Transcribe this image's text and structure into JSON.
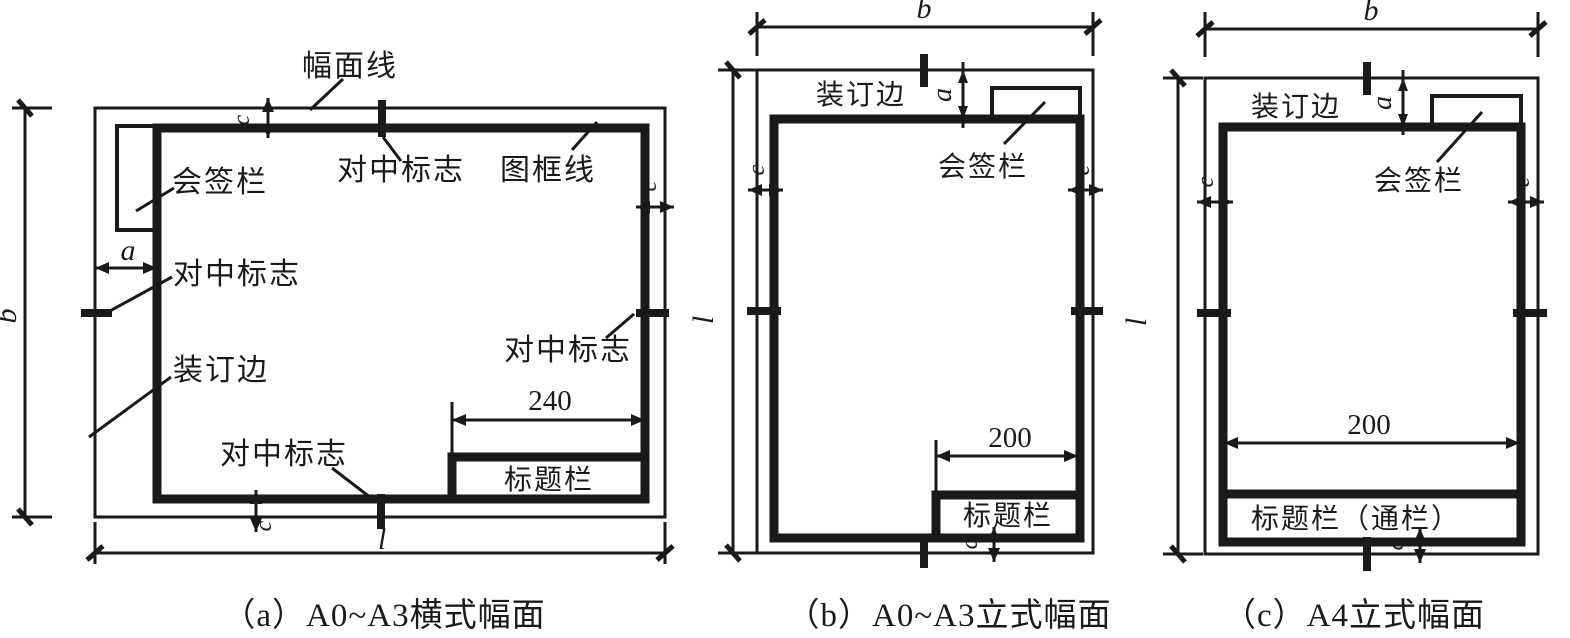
{
  "colors": {
    "ink": "#1a1a1a",
    "background": "#ffffff"
  },
  "diagram_a": {
    "caption": "（a）A0~A3横式幅面",
    "labels": {
      "sheet_line": "幅面线",
      "frame_line": "图框线",
      "centering_mark": "对中标志",
      "signature_bar": "会签栏",
      "binding_edge": "装订边",
      "title_block": "标题栏"
    },
    "dims": {
      "height": "b",
      "length": "l",
      "binding": "a",
      "margin": "c",
      "title_width": "240"
    }
  },
  "diagram_b": {
    "caption": "（b）A0~A3立式幅面",
    "labels": {
      "binding_edge": "装订边",
      "signature_bar": "会签栏",
      "title_block": "标题栏"
    },
    "dims": {
      "width": "b",
      "height": "l",
      "binding": "a",
      "margin": "c",
      "title_width": "200"
    }
  },
  "diagram_c": {
    "caption": "（c）A4立式幅面",
    "labels": {
      "binding_edge": "装订边",
      "signature_bar": "会签栏",
      "title_block": "标题栏（通栏）"
    },
    "dims": {
      "width": "b",
      "height": "l",
      "binding": "a",
      "margin": "c",
      "title_width": "200"
    }
  }
}
